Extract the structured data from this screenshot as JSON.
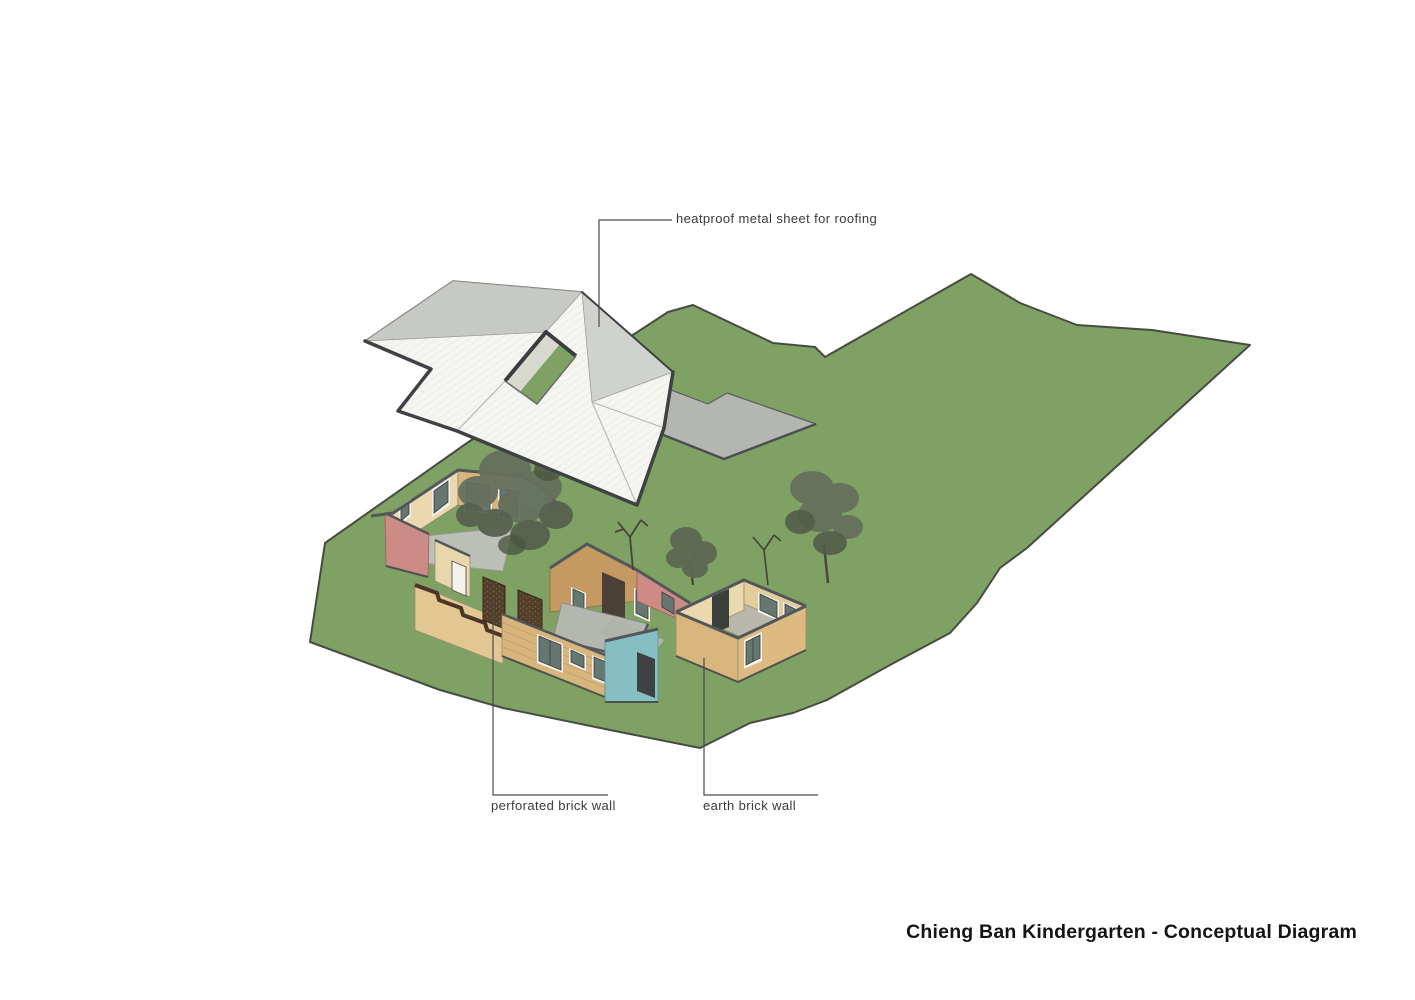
{
  "title": {
    "text": "Chieng Ban Kindergarten - Conceptual Diagram"
  },
  "annotations": {
    "roofing": {
      "label": "heatproof metal sheet for roofing"
    },
    "perforated": {
      "label": "perforated brick wall"
    },
    "earth": {
      "label": "earth brick wall"
    }
  },
  "palette": {
    "grass": "#7fa164",
    "site_outline": "#474b41",
    "roof_white": "#f5f5f2",
    "roof_gray_top": "#c7c9c5",
    "roof_gray_right": "#d0d2ce",
    "roof_edge": "#3f4245",
    "roof_underside": "#d7d9ce",
    "terrace_slab": "#b4b6b2",
    "wall_tan": "#d8b57c",
    "wall_tan_light": "#ebd8ae",
    "wall_wood": "#c49a62",
    "wall_pink": "#cc8b85",
    "wall_blue": "#85bfc3",
    "brick_dark": "#503d2a",
    "floor_gray": "#bdbfb9",
    "window_glass": "#66776f",
    "window_frame": "#f2f1ec",
    "door_dark": "#44484a",
    "tree_green": "#66705c",
    "leader_line": "#4a4a4a",
    "label_text": "#3a3a3a",
    "title_text": "#141414"
  }
}
